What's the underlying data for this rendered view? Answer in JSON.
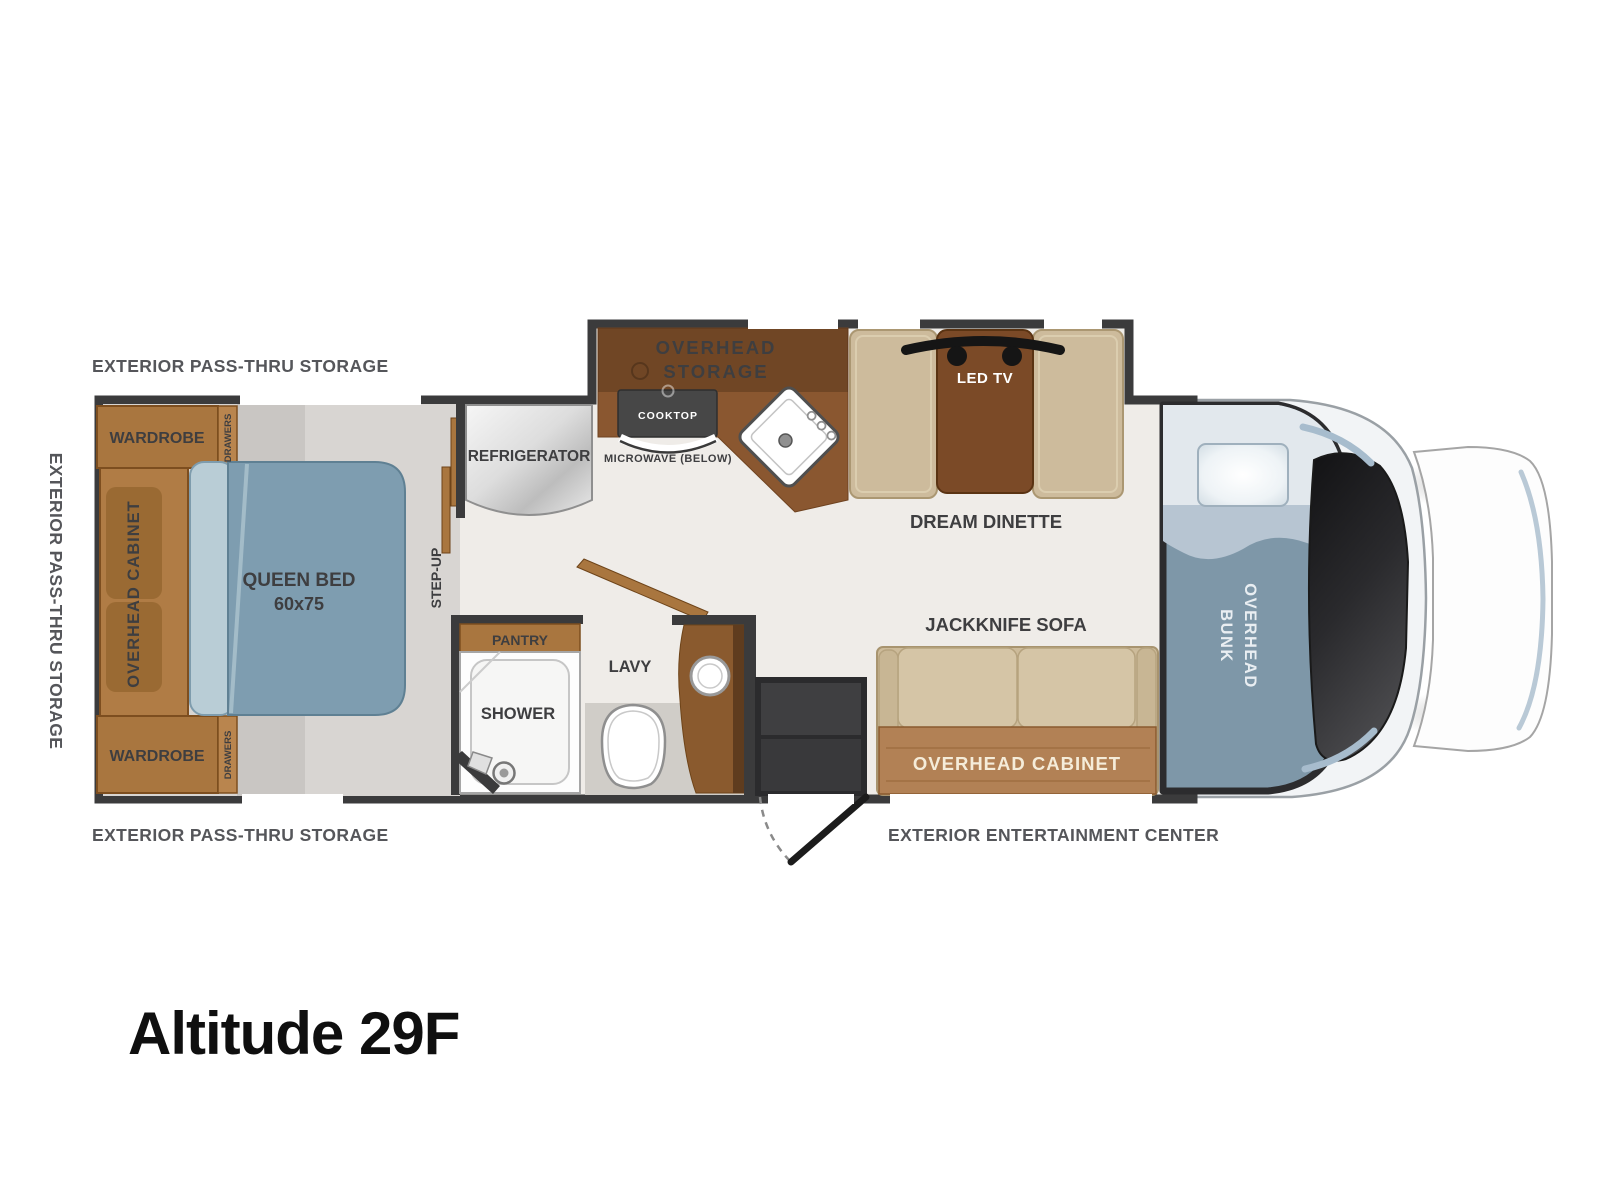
{
  "title": "Altitude 29F",
  "exterior": {
    "pass_thru_top": "EXTERIOR PASS-THRU STORAGE",
    "pass_thru_left": "EXTERIOR PASS-THRU STORAGE",
    "pass_thru_bottom": "EXTERIOR PASS-THRU STORAGE",
    "entertainment": "EXTERIOR ENTERTAINMENT CENTER"
  },
  "bedroom": {
    "wardrobe_top": "WARDROBE",
    "drawers_top": "DRAWERS",
    "overhead_cabinet": "OVERHEAD CABINET",
    "wardrobe_bottom": "WARDROBE",
    "drawers_bottom": "DRAWERS",
    "queen_bed_line1": "QUEEN BED",
    "queen_bed_line2": "60x75",
    "step_up": "STEP-UP"
  },
  "kitchen": {
    "refrigerator": "REFRIGERATOR",
    "overhead_storage_line1": "OVERHEAD",
    "overhead_storage_line2": "STORAGE",
    "cooktop": "COOKTOP",
    "microwave": "MICROWAVE (BELOW)"
  },
  "dinette": {
    "led_tv": "LED TV",
    "label": "DREAM DINETTE"
  },
  "bathroom": {
    "pantry": "PANTRY",
    "shower": "SHOWER",
    "lavy": "LAVY"
  },
  "living": {
    "sofa_label": "JACKKNIFE SOFA",
    "overhead_cabinet": "OVERHEAD CABINET"
  },
  "bunk": {
    "line1": "OVERHEAD",
    "line2": "BUNK"
  },
  "colors": {
    "wall": "#3b3b3c",
    "cabinet_brown": "#a9763f",
    "counter_brown": "#8a5730",
    "table_brown": "#7b4a27",
    "bench_tan": "#cdbb9c",
    "bed_blue": "#7e9db0",
    "bunk_blue": "#7e97a8",
    "floor_cream": "#efece8",
    "floor_gray": "#d8d5d2",
    "label_gray": "#55565a"
  }
}
